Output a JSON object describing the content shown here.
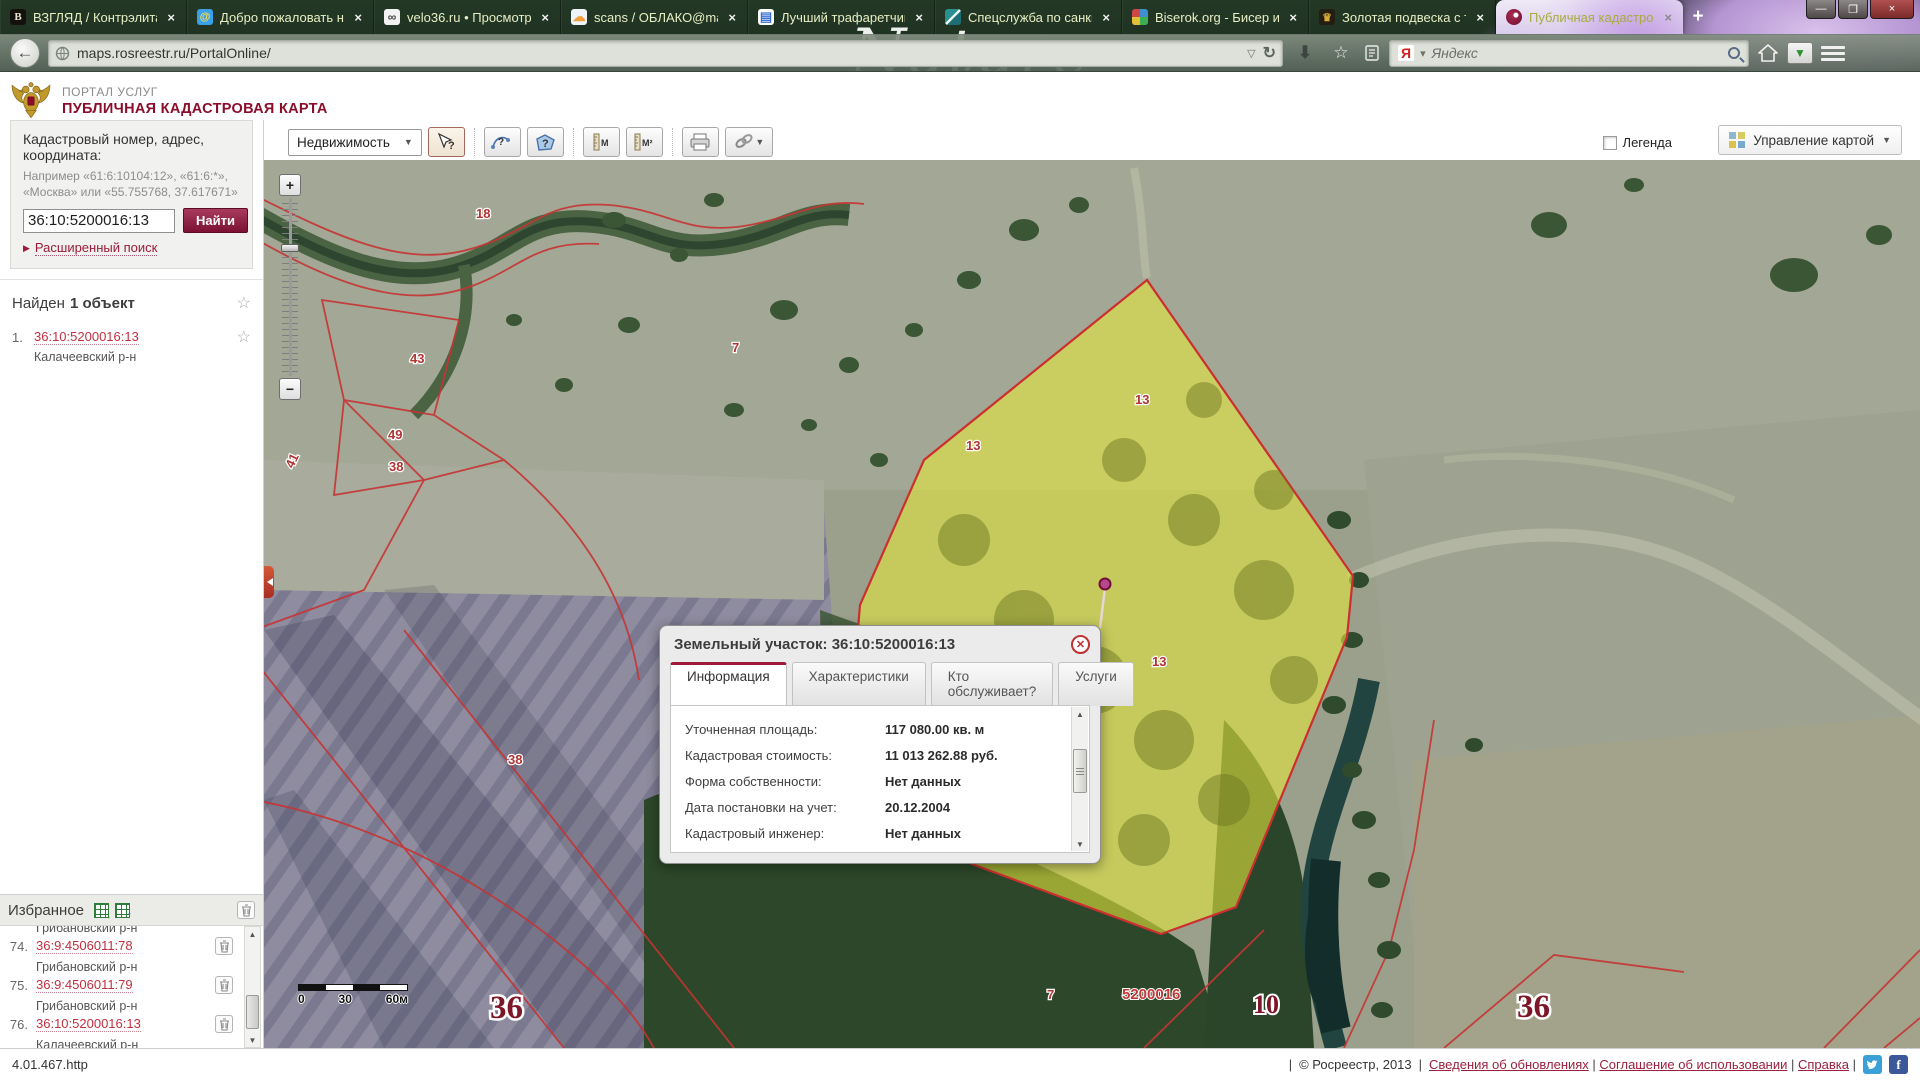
{
  "browser": {
    "theme_text": "Nature",
    "new_tab_label": "+",
    "window_controls": {
      "minimize": "—",
      "restore": "❐",
      "close": "×"
    },
    "tab_close_glyph": "×",
    "url": "maps.rosreestr.ru/PortalOnline/",
    "url_dropdown_glyph": "▽",
    "reload_glyph": "↻",
    "back_glyph": "←",
    "star_glyph": "☆",
    "download_glyph": "⬇",
    "dl_manager_glyph": "▼",
    "search_engine_glyph": "Я",
    "search_placeholder": "Яндекс",
    "tabs": [
      {
        "title": "ВЗГЛЯД / Контрэлита",
        "icon": "vz",
        "glyph": "В",
        "active": false
      },
      {
        "title": "Добро пожаловать на ...",
        "icon": "at",
        "glyph": "@",
        "active": false
      },
      {
        "title": "velo36.ru • Просмотр т...",
        "icon": "bike",
        "glyph": "∞",
        "active": false
      },
      {
        "title": "scans / ОБЛАКО@mail...",
        "icon": "cloud",
        "glyph": "☁",
        "active": false
      },
      {
        "title": "Лучший трафаретчик ...",
        "icon": "doc",
        "glyph": "▤",
        "active": false
      },
      {
        "title": "Спецслужба по санкц...",
        "icon": "teal",
        "glyph": "",
        "active": false
      },
      {
        "title": "Biserok.org - Бисер и б...",
        "icon": "beads",
        "glyph": "",
        "active": false
      },
      {
        "title": "Золотая подвеска с то...",
        "icon": "gold",
        "glyph": "♛",
        "active": false
      },
      {
        "title": "Публичная кадастров...",
        "icon": "ros",
        "glyph": "",
        "active": true
      }
    ]
  },
  "header": {
    "portal_label": "ПОРТАЛ УСЛУГ",
    "title": "ПУБЛИЧНАЯ КАДАСТРОВАЯ КАРТА"
  },
  "toolbar": {
    "realty_dropdown": "Недвижимость",
    "legend_label": "Легенда",
    "manage_button": "Управление картой"
  },
  "sidebar": {
    "search": {
      "label": "Кадастровый номер, адрес, координата:",
      "hint_line1": "Например «61:6:10104:12», «61:6:*»,",
      "hint_line2": "«Москва» или «55.755768, 37.617671»",
      "input_value": "36:10:5200016:13",
      "find_button": "Найти",
      "advanced_link": "Расширенный поиск"
    },
    "results": {
      "header_prefix": "Найден",
      "header_bold": "1 объект",
      "items": [
        {
          "num": "1.",
          "cadastral": "36:10:5200016:13",
          "district": "Калачеевский р-н"
        }
      ]
    },
    "favorites": {
      "title": "Избранное",
      "items": [
        {
          "num": "",
          "cadastral": "",
          "district": "Грибановский р-н"
        },
        {
          "num": "74.",
          "cadastral": "36:9:4506011:78",
          "district": "Грибановский р-н"
        },
        {
          "num": "75.",
          "cadastral": "36:9:4506011:79",
          "district": "Грибановский р-н"
        },
        {
          "num": "76.",
          "cadastral": "36:10:5200016:13",
          "district": "Калачеевский р-н"
        }
      ]
    }
  },
  "map": {
    "zoom_in": "+",
    "zoom_out": "−",
    "scalebar": {
      "t0": "0",
      "t1": "30",
      "t2": "60м"
    },
    "labels": [
      {
        "t": "18",
        "x": 212,
        "y": 58,
        "c": "sm",
        "r": 0
      },
      {
        "t": "43",
        "x": 146,
        "y": 203,
        "c": "sm",
        "r": 0
      },
      {
        "t": "49",
        "x": 124,
        "y": 279,
        "c": "sm",
        "r": 0
      },
      {
        "t": "38",
        "x": 125,
        "y": 311,
        "c": "sm",
        "r": 0
      },
      {
        "t": "41",
        "x": 29,
        "y": 309,
        "c": "sm",
        "r": -65
      },
      {
        "t": "7",
        "x": 468,
        "y": 192,
        "c": "sm",
        "r": 0
      },
      {
        "t": "13",
        "x": 702,
        "y": 290,
        "c": "sm",
        "r": 0
      },
      {
        "t": "13",
        "x": 871,
        "y": 244,
        "c": "sm",
        "r": 0
      },
      {
        "t": "13",
        "x": 888,
        "y": 506,
        "c": "sm",
        "r": 0
      },
      {
        "t": "38",
        "x": 244,
        "y": 604,
        "c": "sm",
        "r": 0
      },
      {
        "t": "7",
        "x": 783,
        "y": 839,
        "c": "sm",
        "r": 0
      },
      {
        "t": "5200016",
        "x": 858,
        "y": 839,
        "c": "md",
        "r": 0
      },
      {
        "t": "10",
        "x": 989,
        "y": 853,
        "c": "lg",
        "r": 0
      },
      {
        "t": "36",
        "x": 226,
        "y": 858,
        "c": "xl",
        "r": 0
      },
      {
        "t": "36",
        "x": 1253,
        "y": 857,
        "c": "xl",
        "r": 0
      }
    ],
    "popup": {
      "title": "Земельный участок: 36:10:5200016:13",
      "close_glyph": "✕",
      "tabs": [
        {
          "label": "Информация",
          "active": true
        },
        {
          "label": "Характеристики",
          "active": false
        },
        {
          "label": "Кто обслуживает?",
          "active": false
        },
        {
          "label": "Услуги",
          "active": false
        }
      ],
      "rows": [
        {
          "label": "Уточненная площадь:",
          "value": "117 080.00 кв. м"
        },
        {
          "label": "Кадастровая стоимость:",
          "value": "11 013 262.88 руб."
        },
        {
          "label": "Форма собственности:",
          "value": "Нет данных"
        },
        {
          "label": "Дата постановки на учет:",
          "value": "20.12.2004"
        },
        {
          "label": "Кадастровый инженер:",
          "value": "Нет данных"
        }
      ]
    }
  },
  "statusbar": {
    "version": "4.01.467.http",
    "copyright": "© Росреестр, 2013",
    "links": [
      "Сведения об обновлениях",
      "Соглашение об использовании",
      "Справка"
    ]
  }
}
